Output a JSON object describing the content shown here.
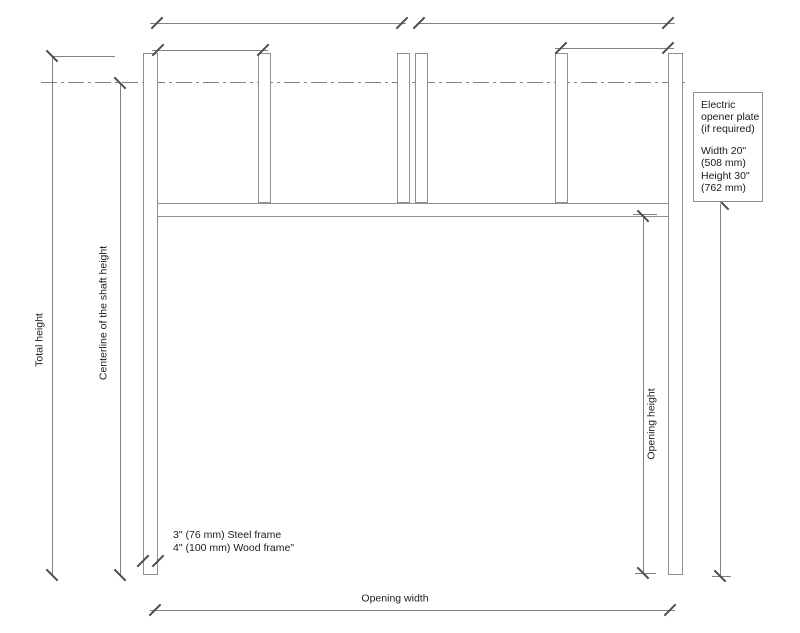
{
  "drawing": {
    "dimensions": {
      "total_height": "Total height",
      "shaft_centerline": "Centerline of the shaft height",
      "opening_height": "Opening height",
      "opening_width": "Opening width"
    },
    "frame_note": {
      "line1": "3\" (76 mm) Steel frame",
      "line2": "4\" (100 mm) Wood frame\""
    },
    "opener_plate_note": {
      "line1": "Electric",
      "line2": "opener plate",
      "line3": "(if required)",
      "width_label": "Width 20\"",
      "width_metric": "(508 mm)",
      "height_label": "Height 30\"",
      "height_metric": "(762 mm)"
    }
  },
  "colors": {
    "bg": "#ffffff",
    "structure_line": "#8f8f8f",
    "dimension_line": "#828282",
    "tick_color": "#4d4d4d",
    "text_color": "#1c1c1c"
  }
}
